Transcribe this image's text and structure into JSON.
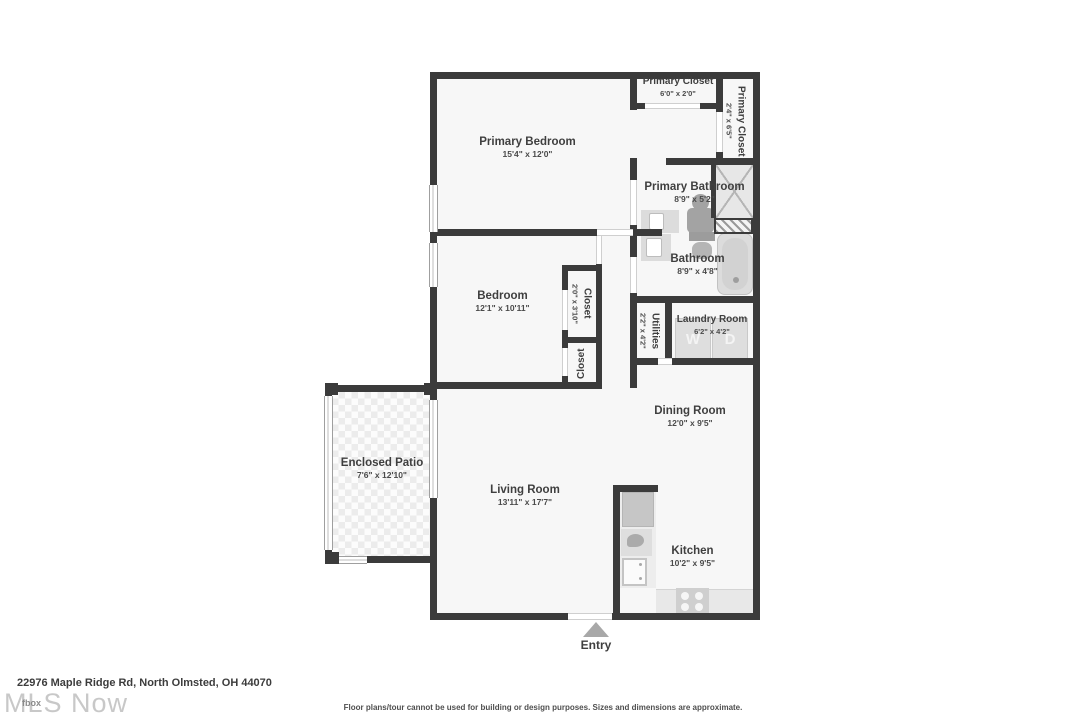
{
  "colors": {
    "wall": "#3b3b3b",
    "floor": "#f7f7f7",
    "fixture": "#dedede",
    "text": "#3f3f3f",
    "watermark": "#c8c8c8",
    "entry_arrow": "#a8a8a8"
  },
  "rooms": [
    {
      "name": "Primary Bedroom",
      "dims": "15'4\" x 12'0\""
    },
    {
      "name": "Primary Closet",
      "dims": "6'0\" x 2'0\""
    },
    {
      "name": "Primary Closet",
      "dims": "2'4\" x 6'5\""
    },
    {
      "name": "Primary Bathroom",
      "dims": "8'9\" x 5'2\""
    },
    {
      "name": "Bathroom",
      "dims": "8'9\" x 4'8\""
    },
    {
      "name": "Bedroom",
      "dims": "12'1\" x 10'11\""
    },
    {
      "name": "Closet",
      "dims": "2'0\" x 3'10\""
    },
    {
      "name": "Closet",
      "dims": ""
    },
    {
      "name": "Utilities",
      "dims": "2'2\" x 4'2\""
    },
    {
      "name": "Laundry Room",
      "dims": "6'2\" x 4'2\""
    },
    {
      "name": "Dining Room",
      "dims": "12'0\" x 9'5\""
    },
    {
      "name": "Enclosed Patio",
      "dims": "7'6\" x 12'10\""
    },
    {
      "name": "Living Room",
      "dims": "13'11\" x 17'7\""
    },
    {
      "name": "Kitchen",
      "dims": "10'2\" x 9'5\""
    }
  ],
  "appliances": {
    "washer": "W",
    "dryer": "D"
  },
  "labels": {
    "entry": "Entry"
  },
  "footer": {
    "address": "22976 Maple Ridge Rd, North Olmsted, OH 44070",
    "disclaimer": "Floor plans/tour cannot be used for building or design purposes. Sizes and dimensions are approximate.",
    "watermark": "MLS Now",
    "watermark_overlay": "fbox"
  }
}
